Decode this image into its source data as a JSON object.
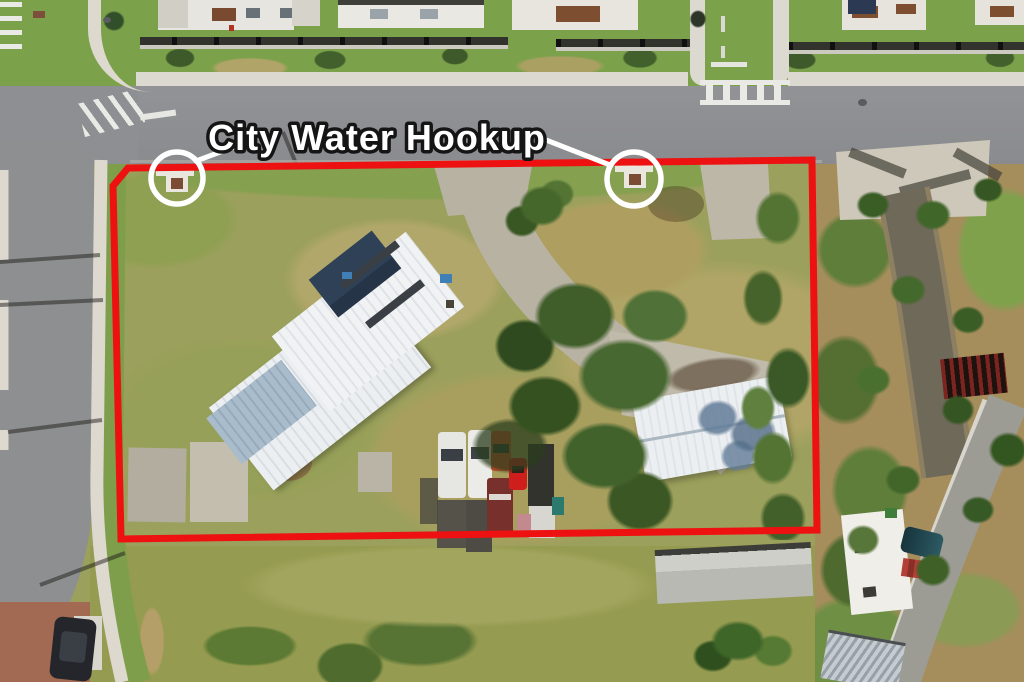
{
  "annotation": {
    "label": "City Water Hookup",
    "boundary_color": "#ee1111",
    "marker_color": "#ffffff",
    "label_fill": "#ffffff",
    "label_outline": "#151515"
  }
}
